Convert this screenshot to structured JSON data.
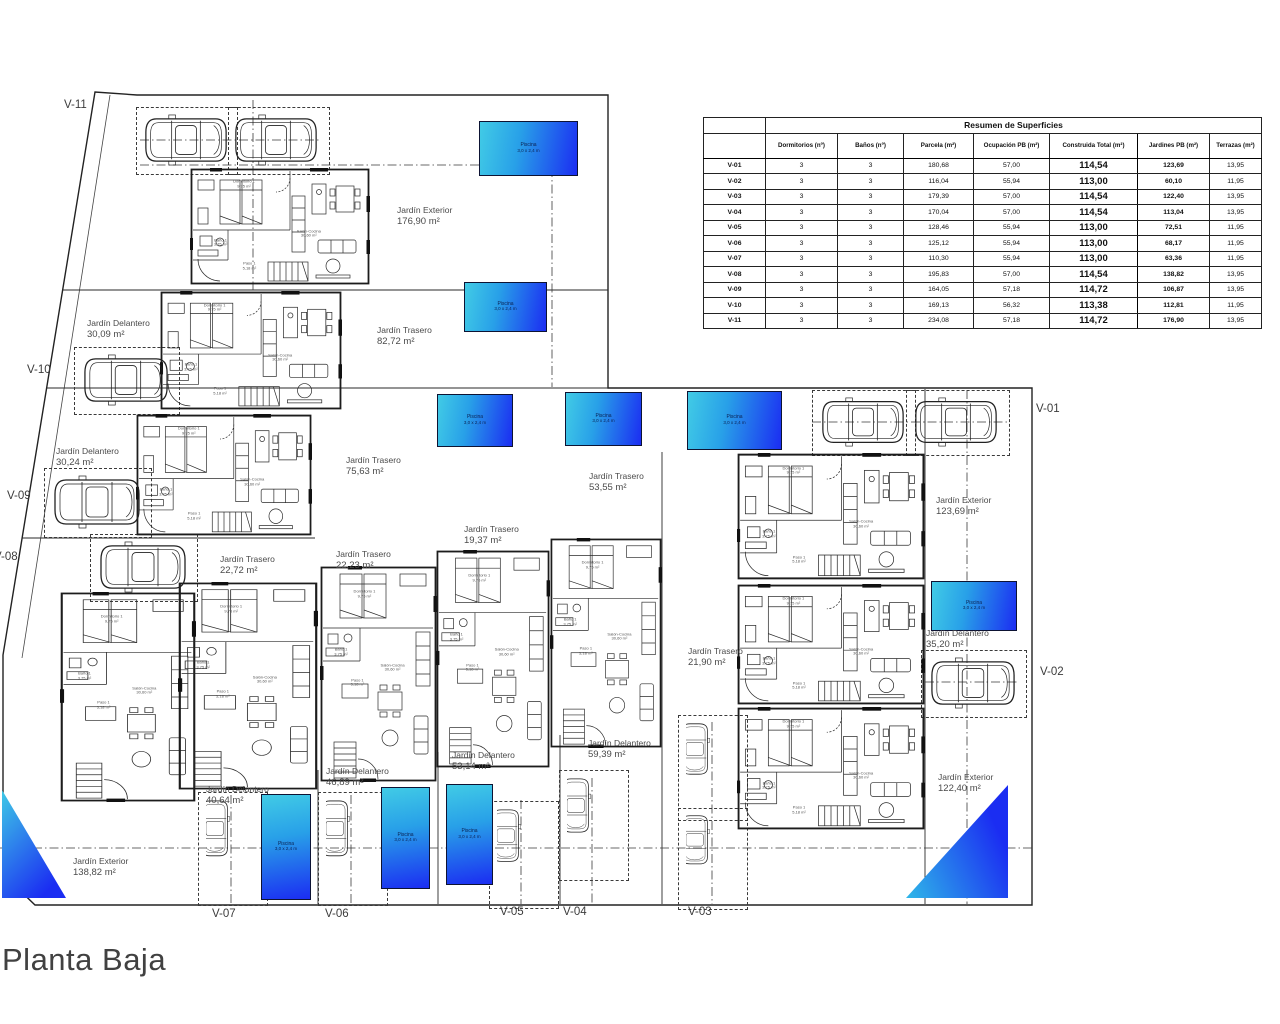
{
  "title": "Planta Baja",
  "table": {
    "title": "Resumen de Superficies",
    "columns": [
      "",
      "Dormitorios (nº)",
      "Baños (nº)",
      "Parcela (m²)",
      "Ocupación PB (m²)",
      "Construida Total (m²)",
      "Jardines PB (m²)",
      "Terrazas (m²)"
    ],
    "rows": [
      {
        "id": "V-01",
        "values": [
          "3",
          "3",
          "180,68",
          "57,00",
          "114,54",
          "123,69",
          "13,95"
        ]
      },
      {
        "id": "V-02",
        "values": [
          "3",
          "3",
          "116,04",
          "55,94",
          "113,00",
          "60,10",
          "11,95"
        ]
      },
      {
        "id": "V-03",
        "values": [
          "3",
          "3",
          "179,39",
          "57,00",
          "114,54",
          "122,40",
          "13,95"
        ]
      },
      {
        "id": "V-04",
        "values": [
          "3",
          "3",
          "170,04",
          "57,00",
          "114,54",
          "113,04",
          "13,95"
        ]
      },
      {
        "id": "V-05",
        "values": [
          "3",
          "3",
          "128,46",
          "55,94",
          "113,00",
          "72,51",
          "11,95"
        ]
      },
      {
        "id": "V-06",
        "values": [
          "3",
          "3",
          "125,12",
          "55,94",
          "113,00",
          "68,17",
          "11,95"
        ]
      },
      {
        "id": "V-07",
        "values": [
          "3",
          "3",
          "110,30",
          "55,94",
          "113,00",
          "63,36",
          "11,95"
        ]
      },
      {
        "id": "V-08",
        "values": [
          "3",
          "3",
          "195,83",
          "57,00",
          "114,54",
          "138,82",
          "13,95"
        ]
      },
      {
        "id": "V-09",
        "values": [
          "3",
          "3",
          "164,05",
          "57,18",
          "114,72",
          "106,87",
          "13,95"
        ]
      },
      {
        "id": "V-10",
        "values": [
          "3",
          "3",
          "169,13",
          "56,32",
          "113,38",
          "112,81",
          "11,95"
        ]
      },
      {
        "id": "V-11",
        "values": [
          "3",
          "3",
          "234,08",
          "57,18",
          "114,72",
          "176,90",
          "13,95"
        ]
      }
    ]
  },
  "plan": {
    "pool_label": "Piscina",
    "pool_dims": "3,0 x 2,4 m",
    "room_labels": {
      "dormitorio": [
        "Dormitorio 1",
        "9,75 m²"
      ],
      "bano": [
        "Baño 1",
        "3,75 m²"
      ],
      "paso": [
        "Paso 1",
        "5,18 m²"
      ],
      "salon": [
        "Salón-Cocina",
        "30,60 m²"
      ]
    },
    "unit_labels": [
      {
        "id": "V-11",
        "x": 64,
        "y": 99
      },
      {
        "id": "V-10",
        "x": 27,
        "y": 364
      },
      {
        "id": "V-09",
        "x": 7,
        "y": 490
      },
      {
        "id": "V-08",
        "x": -6,
        "y": 551
      },
      {
        "id": "V-01",
        "x": 1036,
        "y": 403
      },
      {
        "id": "V-02",
        "x": 1040,
        "y": 666
      },
      {
        "id": "V-07",
        "x": 212,
        "y": 908
      },
      {
        "id": "V-06",
        "x": 325,
        "y": 908
      },
      {
        "id": "V-05",
        "x": 500,
        "y": 906
      },
      {
        "id": "V-04",
        "x": 563,
        "y": 906
      },
      {
        "id": "V-03",
        "x": 688,
        "y": 906
      }
    ],
    "gardens": [
      {
        "name": "Jardín Exterior",
        "area": "176,90 m²",
        "x": 397,
        "y": 205
      },
      {
        "name": "Jardín Delantero",
        "area": "30,09 m²",
        "x": 87,
        "y": 318
      },
      {
        "name": "Jardín Trasero",
        "area": "82,72 m²",
        "x": 377,
        "y": 325
      },
      {
        "name": "Jardín Delantero",
        "area": "30,24 m²",
        "x": 56,
        "y": 446
      },
      {
        "name": "Jardín Trasero",
        "area": "75,63 m²",
        "x": 346,
        "y": 455
      },
      {
        "name": "Jardín Trasero",
        "area": "53,55 m²",
        "x": 589,
        "y": 471
      },
      {
        "name": "Jardín Trasero",
        "area": "19,37 m²",
        "x": 464,
        "y": 524
      },
      {
        "name": "Jardín Trasero",
        "area": "22,23 m²",
        "x": 336,
        "y": 549
      },
      {
        "name": "Jardín Trasero",
        "area": "22,72 m²",
        "x": 220,
        "y": 554
      },
      {
        "name": "Jardín Exterior",
        "area": "123,69 m²",
        "x": 936,
        "y": 495
      },
      {
        "name": "Jardín Trasero",
        "area": "21,90 m²",
        "x": 688,
        "y": 646
      },
      {
        "name": "Jardín Delantero",
        "area": "35,20 m²",
        "x": 926,
        "y": 628
      },
      {
        "name": "Jardín Delantero",
        "area": "59,39 m²",
        "x": 588,
        "y": 738
      },
      {
        "name": "Jardín Delantero",
        "area": "53,14 m²",
        "x": 452,
        "y": 750
      },
      {
        "name": "Jardín Delantero",
        "area": "46,89 m²",
        "x": 326,
        "y": 766
      },
      {
        "name": "Jardín Delantero",
        "area": "40,64 m²",
        "x": 206,
        "y": 784
      },
      {
        "name": "Jardín Exterior",
        "area": "138,82 m²",
        "x": 73,
        "y": 856
      },
      {
        "name": "Jardín Exterior",
        "area": "122,40 m²",
        "x": 938,
        "y": 772
      }
    ],
    "villas": [
      {
        "x": 190,
        "y": 168,
        "w": 180,
        "h": 117,
        "o": "h"
      },
      {
        "x": 160,
        "y": 291,
        "w": 182,
        "h": 119,
        "o": "h"
      },
      {
        "x": 136,
        "y": 414,
        "w": 176,
        "h": 122,
        "o": "h"
      },
      {
        "x": 737,
        "y": 453,
        "w": 188,
        "h": 127,
        "o": "h"
      },
      {
        "x": 737,
        "y": 584,
        "w": 188,
        "h": 121,
        "o": "h"
      },
      {
        "x": 737,
        "y": 707,
        "w": 188,
        "h": 123,
        "o": "h"
      },
      {
        "x": 60,
        "y": 592,
        "w": 136,
        "h": 210,
        "o": "v"
      },
      {
        "x": 178,
        "y": 582,
        "w": 140,
        "h": 208,
        "o": "v"
      },
      {
        "x": 320,
        "y": 566,
        "w": 117,
        "h": 216,
        "o": "v"
      },
      {
        "x": 436,
        "y": 550,
        "w": 114,
        "h": 218,
        "o": "v"
      },
      {
        "x": 550,
        "y": 538,
        "w": 112,
        "h": 210,
        "o": "v"
      }
    ],
    "pools": [
      {
        "x": 479,
        "y": 121,
        "w": 97,
        "h": 53,
        "o": "h"
      },
      {
        "x": 464,
        "y": 282,
        "w": 81,
        "h": 48,
        "o": "h"
      },
      {
        "x": 437,
        "y": 394,
        "w": 74,
        "h": 51,
        "o": "h"
      },
      {
        "x": 565,
        "y": 392,
        "w": 75,
        "h": 52,
        "o": "h"
      },
      {
        "x": 687,
        "y": 391,
        "w": 93,
        "h": 57,
        "o": "h"
      },
      {
        "x": 931,
        "y": 581,
        "w": 84,
        "h": 48,
        "o": "h"
      },
      {
        "x": 261,
        "y": 794,
        "w": 48,
        "h": 104,
        "o": "v"
      },
      {
        "x": 381,
        "y": 787,
        "w": 47,
        "h": 100,
        "o": "v"
      },
      {
        "x": 446,
        "y": 784,
        "w": 45,
        "h": 99,
        "o": "v"
      }
    ],
    "pool_triangles": [
      {
        "x": 2,
        "y": 790,
        "w": 64,
        "h": 108,
        "kind": "bl"
      },
      {
        "x": 906,
        "y": 785,
        "w": 102,
        "h": 113,
        "kind": "br"
      }
    ],
    "cars": [
      {
        "x": 143,
        "y": 114,
        "w": 86,
        "h": 52,
        "o": "h"
      },
      {
        "x": 233,
        "y": 114,
        "w": 86,
        "h": 52,
        "o": "h"
      },
      {
        "x": 82,
        "y": 354,
        "w": 88,
        "h": 52,
        "o": "h"
      },
      {
        "x": 52,
        "y": 475,
        "w": 90,
        "h": 54,
        "o": "h"
      },
      {
        "x": 98,
        "y": 541,
        "w": 90,
        "h": 52,
        "o": "h"
      },
      {
        "x": 820,
        "y": 397,
        "w": 86,
        "h": 50,
        "o": "h"
      },
      {
        "x": 913,
        "y": 397,
        "w": 86,
        "h": 50,
        "o": "h"
      },
      {
        "x": 929,
        "y": 657,
        "w": 88,
        "h": 52,
        "o": "h"
      },
      {
        "x": 206,
        "y": 799,
        "w": 52,
        "h": 98,
        "o": "v"
      },
      {
        "x": 326,
        "y": 799,
        "w": 52,
        "h": 98,
        "o": "v"
      },
      {
        "x": 497,
        "y": 808,
        "w": 52,
        "h": 92,
        "o": "v"
      },
      {
        "x": 567,
        "y": 777,
        "w": 52,
        "h": 95,
        "o": "v"
      },
      {
        "x": 686,
        "y": 722,
        "w": 52,
        "h": 90,
        "o": "v"
      },
      {
        "x": 686,
        "y": 814,
        "w": 52,
        "h": 86,
        "o": "v"
      }
    ],
    "parking": [
      {
        "x": 136,
        "y": 107,
        "w": 100,
        "h": 66
      },
      {
        "x": 228,
        "y": 107,
        "w": 100,
        "h": 66
      },
      {
        "x": 74,
        "y": 347,
        "w": 104,
        "h": 66
      },
      {
        "x": 44,
        "y": 468,
        "w": 106,
        "h": 68
      },
      {
        "x": 90,
        "y": 534,
        "w": 106,
        "h": 66
      },
      {
        "x": 812,
        "y": 390,
        "w": 102,
        "h": 64
      },
      {
        "x": 906,
        "y": 390,
        "w": 102,
        "h": 64
      },
      {
        "x": 921,
        "y": 650,
        "w": 104,
        "h": 66
      },
      {
        "x": 198,
        "y": 792,
        "w": 68,
        "h": 112
      },
      {
        "x": 318,
        "y": 792,
        "w": 68,
        "h": 112
      },
      {
        "x": 489,
        "y": 801,
        "w": 68,
        "h": 106
      },
      {
        "x": 559,
        "y": 770,
        "w": 68,
        "h": 109
      },
      {
        "x": 678,
        "y": 715,
        "w": 68,
        "h": 104
      },
      {
        "x": 678,
        "y": 808,
        "w": 68,
        "h": 100
      }
    ]
  }
}
